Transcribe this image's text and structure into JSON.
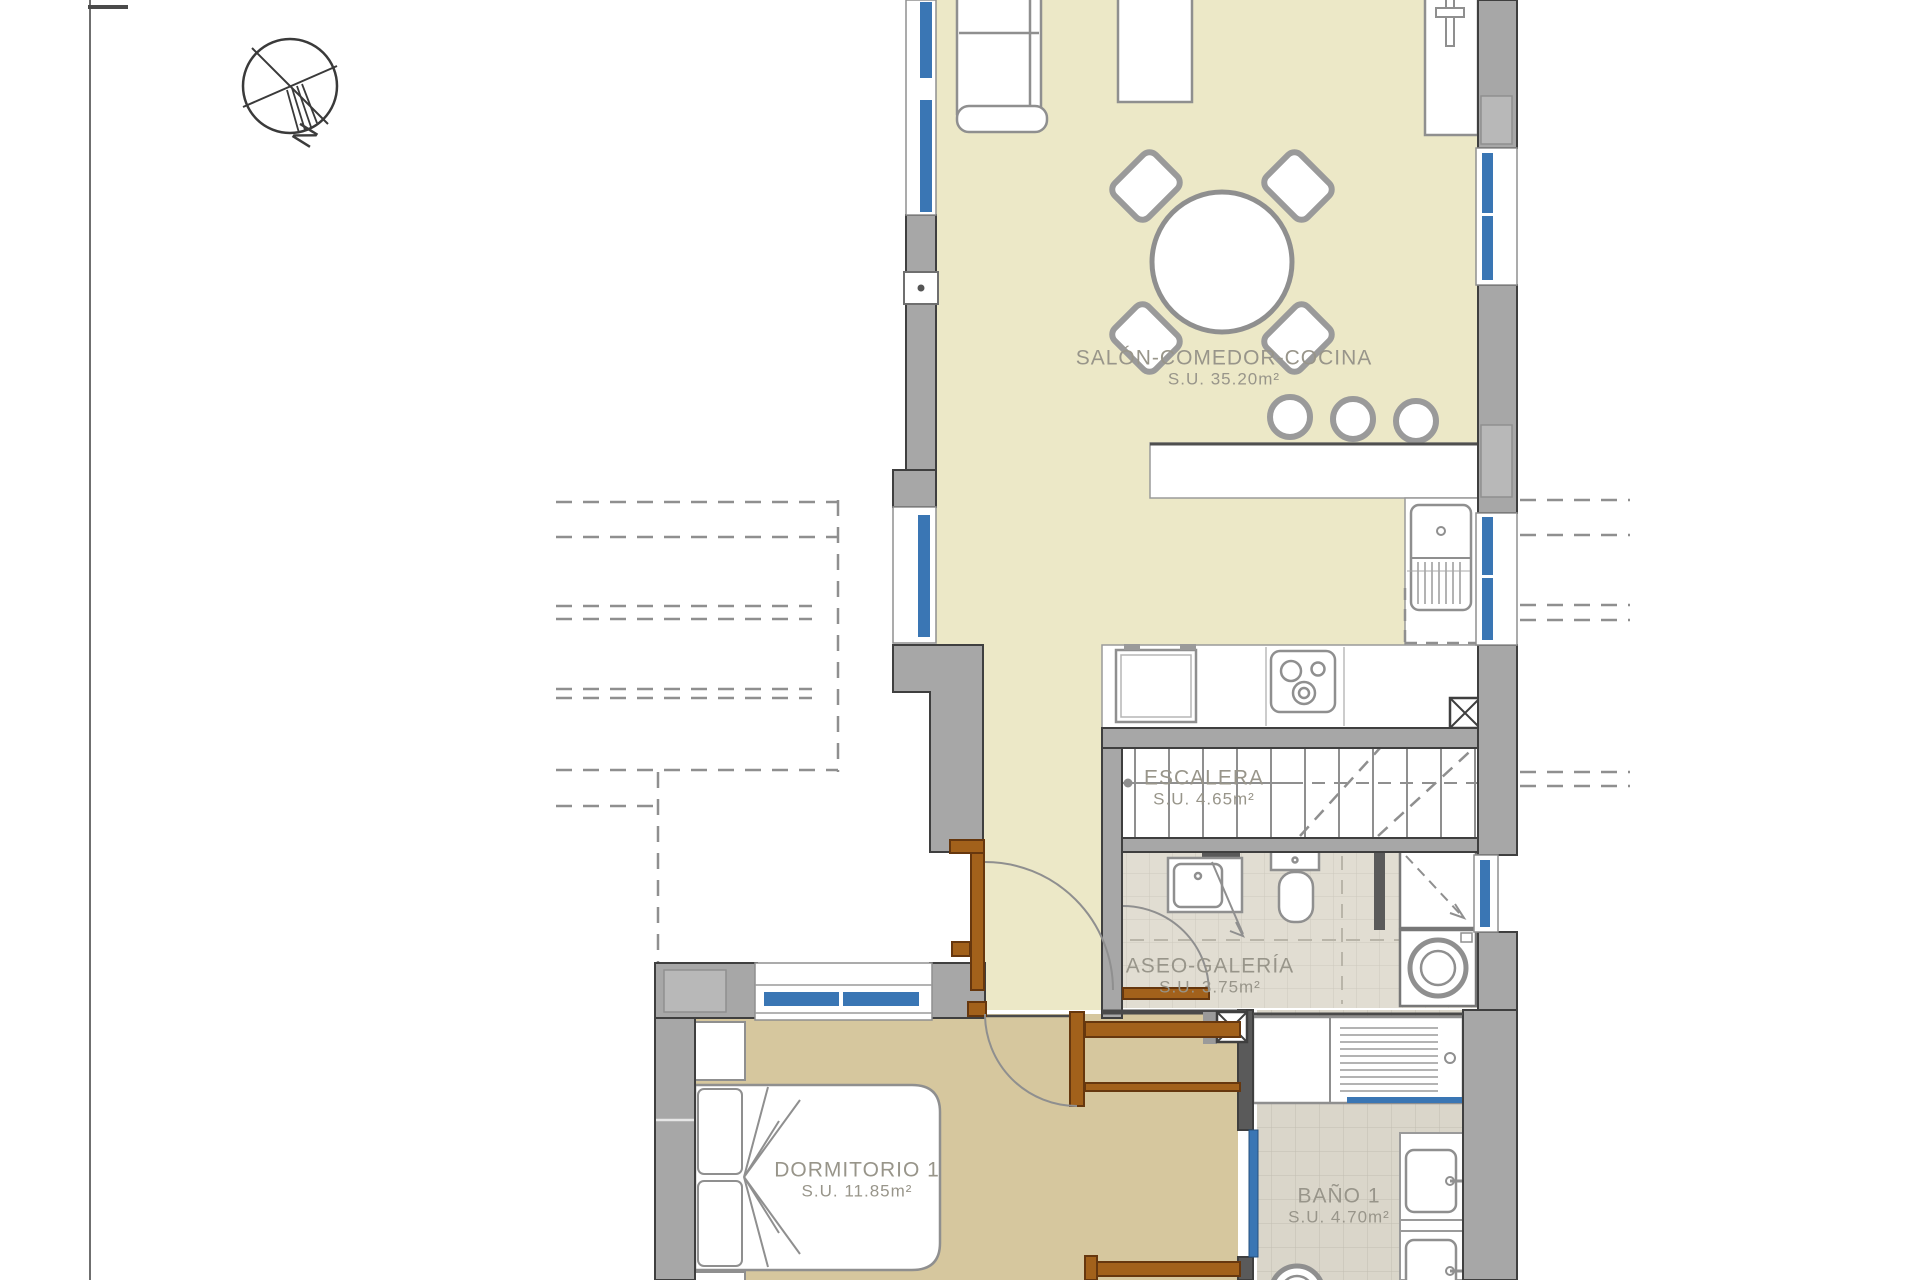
{
  "compass": {
    "label": "N"
  },
  "rooms": [
    {
      "name": "SALÓN-COMEDOR-COCINA",
      "area": "S.U. 35.20m²"
    },
    {
      "name": "ESCALERA",
      "area": "S.U. 4.65m²"
    },
    {
      "name": "ASEO-GALERÍA",
      "area": "S.U. 3.75m²"
    },
    {
      "name": "DORMITORIO 1",
      "area": "S.U. 11.85m²"
    },
    {
      "name": "BAÑO 1",
      "area": "S.U. 4.70m²"
    }
  ],
  "colors": {
    "floor_living": "#ece8c7",
    "floor_hall_tan": "#d6c79e",
    "tile_aseo": "#e1ddd2",
    "tile_bath": "#dad6ca",
    "wall_gray": "#a7a7a7",
    "wall_dark": "#4f4f4f",
    "window_blue": "#3a76b4",
    "door_brown": "#a2611b",
    "label_text": "#98958a",
    "line_gray": "#8f8f8f"
  }
}
